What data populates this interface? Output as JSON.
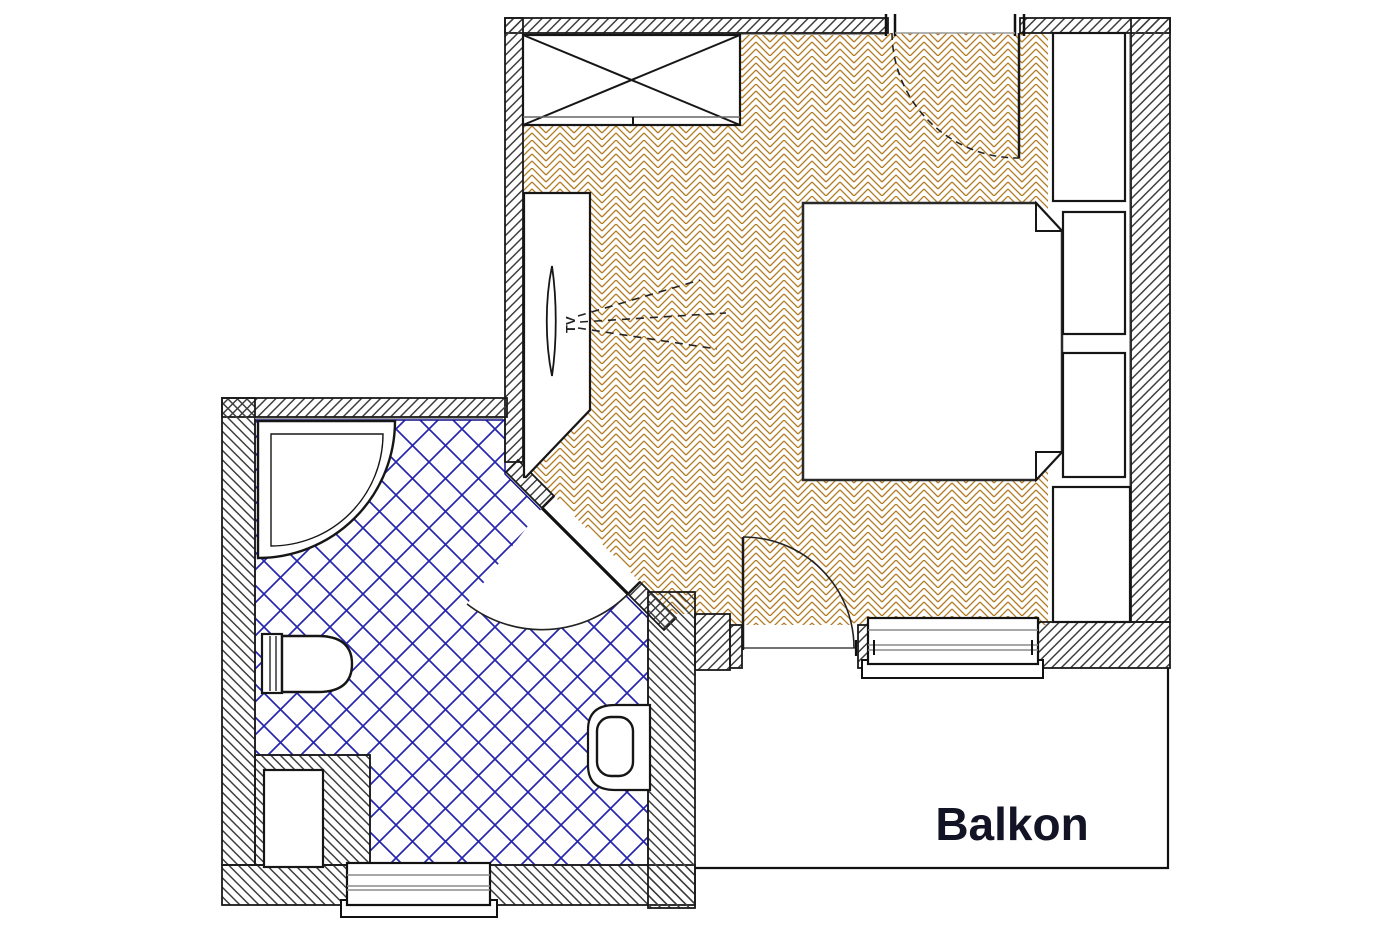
{
  "plan": {
    "labels": {
      "balcony": "Balkon",
      "tv": "TV"
    },
    "colors": {
      "parquet": "#b27c24",
      "tile": "#2626ae",
      "wall_hatch": "#3d3d3d",
      "outline": "#161616",
      "label_text": "#131326"
    },
    "rooms": [
      {
        "name": "bedroom",
        "floor": "herringbone-parquet"
      },
      {
        "name": "bathroom",
        "floor": "blue-diagonal-tile"
      },
      {
        "name": "balcony",
        "label": "Balkon"
      }
    ],
    "furniture": [
      "wardrobe",
      "tv-sideboard",
      "tv",
      "double-bed",
      "nightstand-upper",
      "nightstand-lower",
      "closet-top",
      "closet-bottom",
      "corner-shower",
      "toilet",
      "sink-vanity",
      "wall-niche"
    ],
    "openings": [
      "entrance-door",
      "bathroom-door",
      "balcony-door",
      "bedroom-window",
      "bathroom-window"
    ]
  }
}
